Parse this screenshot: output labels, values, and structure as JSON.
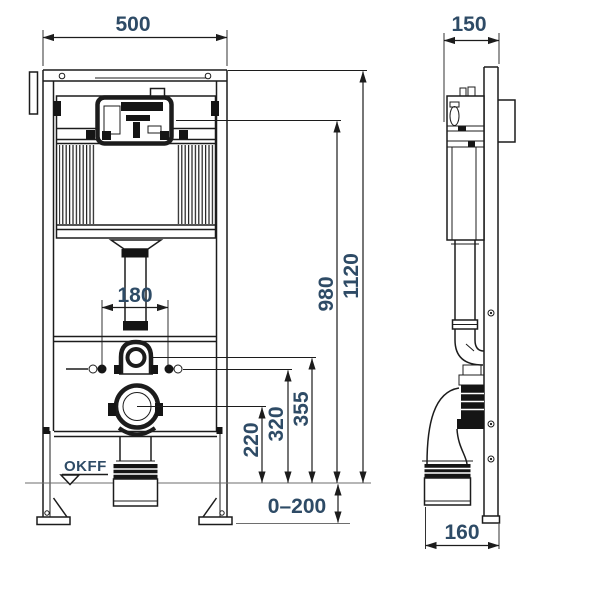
{
  "drawing": {
    "front_view": {
      "width_mm": "500",
      "fixing_spacing_mm": "180",
      "drain_center_height_mm": "220",
      "water_supply_height_mm": "320",
      "flush_pipe_height_mm": "355",
      "actuator_height_mm": "980",
      "frame_height_mm": "1120",
      "leg_adjustment_mm": "0–200",
      "floor_level_label": "OKFF"
    },
    "side_view": {
      "depth_mm": "150",
      "outlet_offset_mm": "160"
    }
  }
}
